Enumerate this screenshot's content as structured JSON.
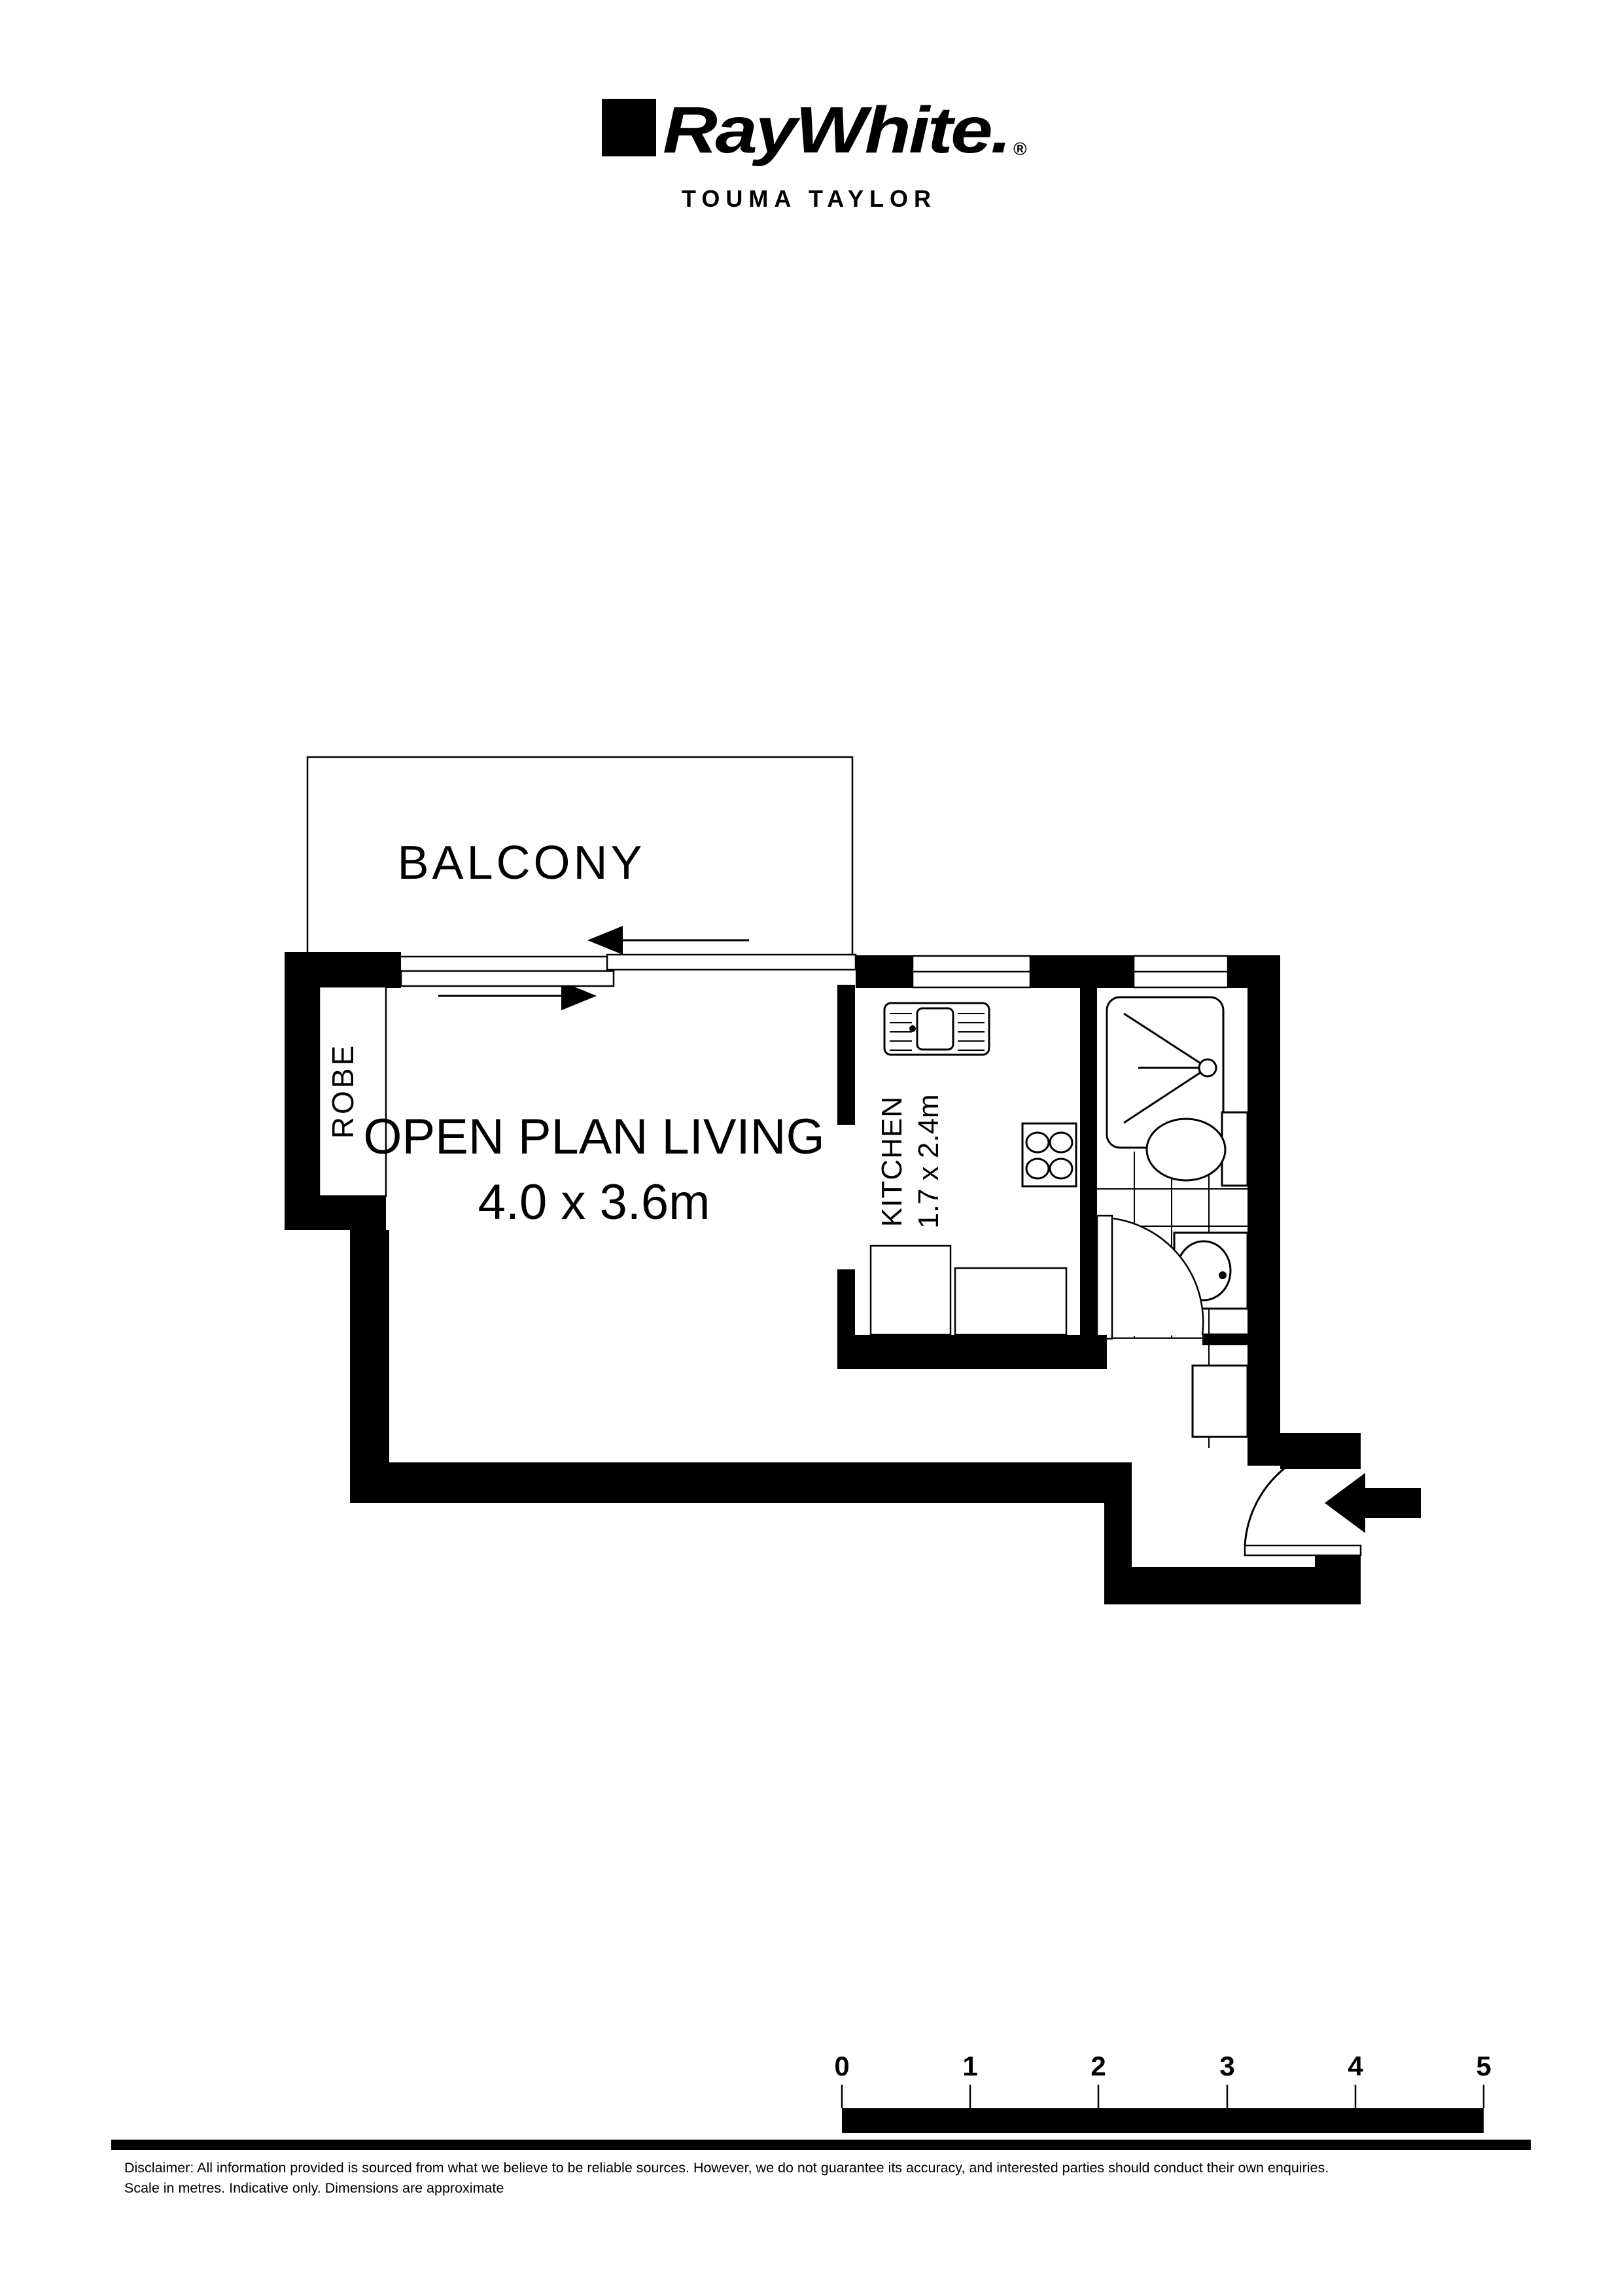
{
  "colors": {
    "wall": "#000000",
    "background": "#ffffff"
  },
  "header": {
    "brand": "RayWhite.",
    "registered_mark": "®",
    "office_name": "TOUMA TAYLOR"
  },
  "plan": {
    "balcony": {
      "label": "BALCONY"
    },
    "robe": {
      "label": "ROBE"
    },
    "living": {
      "label": "OPEN PLAN LIVING",
      "dimensions": "4.0 x 3.6m"
    },
    "kitchen": {
      "label": "KITCHEN",
      "dimensions": "1.7 x 2.4m"
    }
  },
  "scale_bar": {
    "labels": [
      "0",
      "1",
      "2",
      "3",
      "4",
      "5"
    ]
  },
  "disclaimer": {
    "line1": "Disclaimer: All information provided is sourced from what we believe to be reliable sources. However, we do not guarantee  its accuracy, and interested parties should conduct their own enquiries.",
    "line2": "Scale in metres. Indicative only. Dimensions are approximate"
  }
}
